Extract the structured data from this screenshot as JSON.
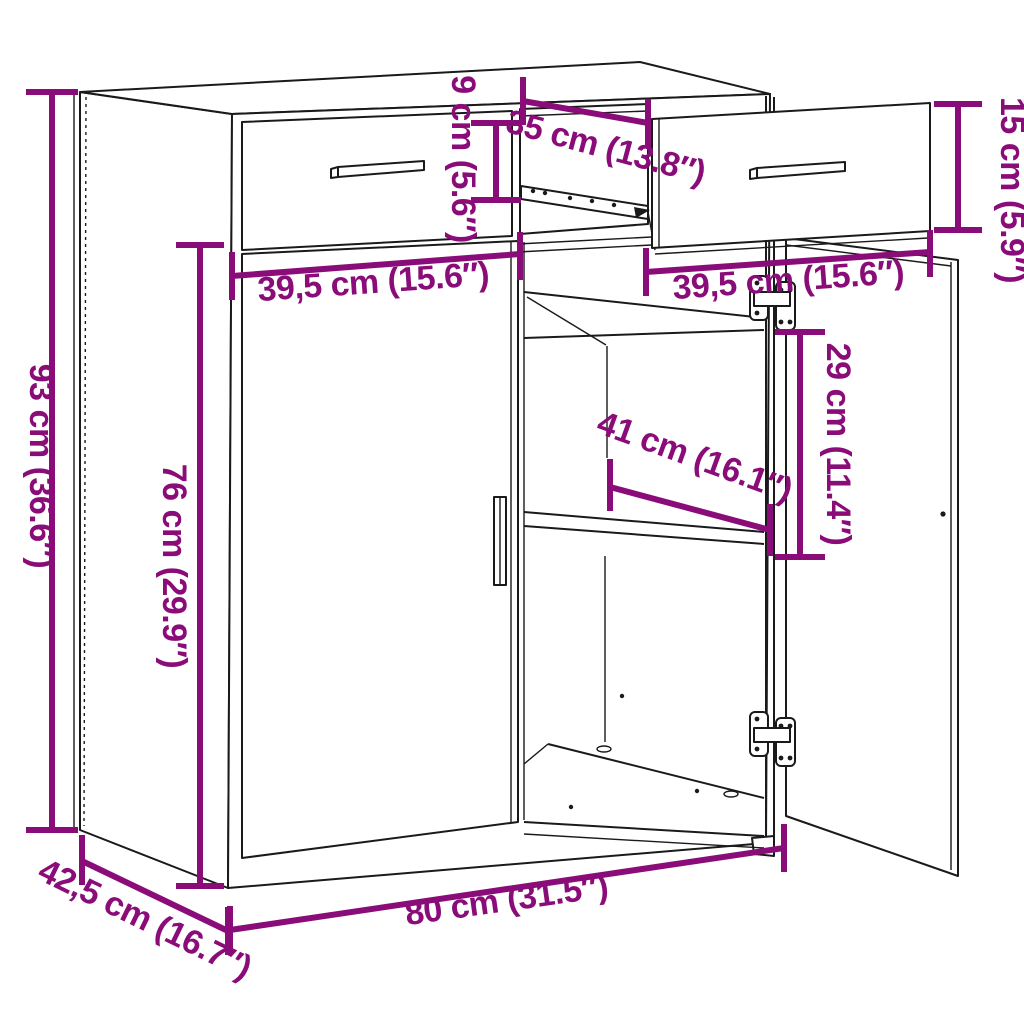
{
  "diagram": {
    "kind": "furniture-dimension-diagram",
    "item": "sideboard with two drawers (one pulled out) and two doors (one open)",
    "background": "#ffffff",
    "line_color": "#1a1a1a",
    "accent_color": "#8a0c79"
  },
  "dimensions": {
    "total_height": {
      "cm": "93",
      "inch": "36.6",
      "label": "93 cm (36.6″)"
    },
    "door_height": {
      "cm": "76",
      "inch": "29.9",
      "label": "76 cm (29.9″)"
    },
    "drawer_inner_height": {
      "cm": "9",
      "inch": "5.6",
      "label": "9 cm (5.6″)"
    },
    "drawer_depth": {
      "cm": "35",
      "inch": "13.8",
      "label": "35 cm (13.8″)"
    },
    "drawer_front_height": {
      "cm": "15",
      "inch": "5.9",
      "label": "15 cm (5.9″)"
    },
    "drawer_width_left": {
      "cm": "39,5",
      "inch": "15.6",
      "label": "39,5 cm (15.6″)"
    },
    "drawer_width_right": {
      "cm": "39,5",
      "inch": "15.6",
      "label": "39,5 cm (15.6″)"
    },
    "shelf_spacing": {
      "cm": "29",
      "inch": "11.4",
      "label": "29 cm (11.4″)"
    },
    "inner_width": {
      "cm": "41",
      "inch": "16.1",
      "label": "41 cm (16.1″)"
    },
    "total_width": {
      "cm": "80",
      "inch": "31.5",
      "label": "80 cm (31.5″)"
    },
    "total_depth": {
      "cm": "42,5",
      "inch": "16.7",
      "label": "42,5 cm (16.7″)"
    }
  }
}
